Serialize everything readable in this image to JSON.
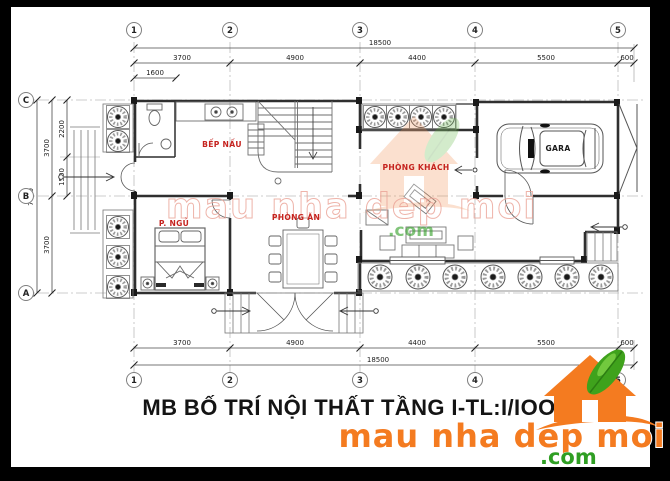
{
  "title": "MB BỐ TRÍ NỘI THẤT TẦNG I-TL:I/IOO",
  "grid": {
    "columns": [
      "1",
      "2",
      "3",
      "4",
      "5"
    ],
    "rows": [
      "C",
      "B",
      "A"
    ]
  },
  "dims": {
    "overall": "18500",
    "segments": [
      "3700",
      "4900",
      "4400",
      "5500",
      "600"
    ],
    "sub_top": "1600",
    "overall_left": "7400",
    "left_segments": [
      "3700",
      "3700"
    ],
    "left_subs": [
      "2200",
      "1500"
    ]
  },
  "rooms": {
    "kitchen": "BẾP NẤU",
    "living": "PHÒNG KHÁCH",
    "dining": "PHÒNG ĂN",
    "bedroom": "P. NGỦ",
    "garage": "GARA"
  },
  "watermark": {
    "brand": "mau nha dep moi",
    "tld": ".com"
  },
  "logo": {
    "brand": "mau nha dep moi",
    "tld": ".com"
  },
  "colors": {
    "room_label": "#c5231f",
    "orange": "#f47b20",
    "green": "#2f9e23",
    "watermark_pink": "#eaa296"
  }
}
